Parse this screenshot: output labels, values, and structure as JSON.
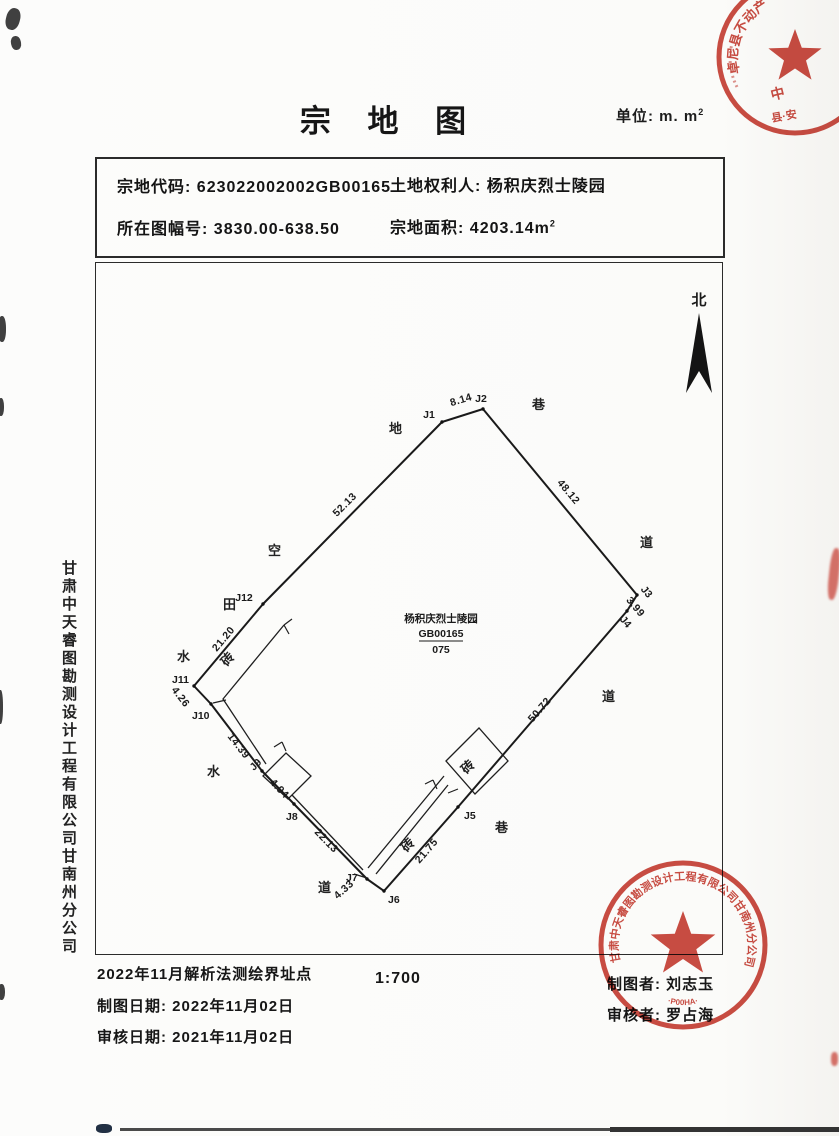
{
  "title": "宗 地 图",
  "unit": {
    "label": "单位: m. m",
    "sup": "2"
  },
  "info": {
    "code_label": "宗地代码:",
    "code_value": "623022002002GB00165",
    "owner_label": "土地权利人:",
    "owner_value": "杨积庆烈士陵园",
    "sheet_label": "所在图幅号:",
    "sheet_value": "3830.00-638.50",
    "area_label": "宗地面积:",
    "area_value": "4203.14m",
    "area_sup": "2"
  },
  "map": {
    "north": "北",
    "center": {
      "name": "杨积庆烈士陵园",
      "code": "GB00165",
      "number": "075"
    },
    "points": {
      "J1": "J1",
      "J2": "J2",
      "J3": "J3",
      "J4": "J4",
      "J5": "J5",
      "J6": "J6",
      "J7": "J7",
      "J8": "J8",
      "J9": "J9",
      "J10": "J10",
      "J11": "J11",
      "J12": "J12"
    },
    "distances": {
      "j1j2": "8.14",
      "j2j3": "48.12",
      "j3j4": "3.99",
      "j4j5": "50.72",
      "j5j6": "21.75",
      "j6j7": "4.33",
      "j7j8": "22.13",
      "j8j9": "4.94",
      "j9j10": "14.39",
      "j10j11": "4.26",
      "j11j12": "21.20",
      "j12j1": "52.13"
    },
    "land_use": {
      "di": "地",
      "xiang": "巷",
      "dao": "道",
      "shui": "水",
      "kong": "空",
      "tian": "田",
      "zhuan": "砖"
    }
  },
  "sidebar_company": "甘肃中天睿图勘测设计工程有限公司甘南州分公司",
  "footer": {
    "note": "2022年11月解析法测绘界址点",
    "draw_label": "制图日期:",
    "draw_date": "2022年11月02日",
    "review_label": "审核日期:",
    "review_date": "2021年11月02日",
    "scale": "1:700",
    "drafter_label": "制图者:",
    "drafter": "刘志玉",
    "reviewer_label": "审核者:",
    "reviewer": "罗占海"
  },
  "seals": {
    "bottom": {
      "arc": "甘肃中天睿图勘测设计工程有限公司甘南州分公司",
      "code": "·P00HA·"
    },
    "top": {
      "arc": "卓尼县不动产",
      "inner": "中",
      "script": "县·安"
    }
  },
  "colors": {
    "seal_red": "#c5392e",
    "ink": "#1c1c1c"
  }
}
